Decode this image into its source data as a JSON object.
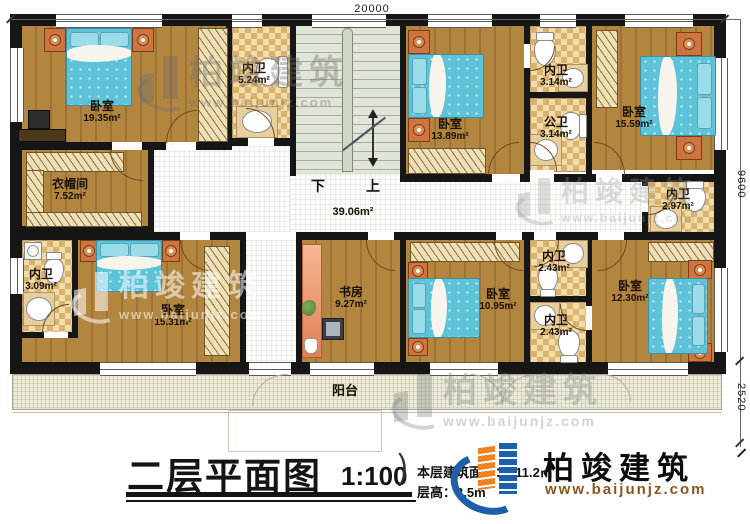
{
  "dims": {
    "top": "20000",
    "right_upper": "9600",
    "right_lower": "2520"
  },
  "rooms": [
    {
      "name": "卧室",
      "area": "19.35m²"
    },
    {
      "name": "内卫",
      "area": "5.24m²"
    },
    {
      "name": "卧室",
      "area": "13.89m²"
    },
    {
      "name": "内卫",
      "area": "3.14m²"
    },
    {
      "name": "公卫",
      "area": "3.14m²"
    },
    {
      "name": "卧室",
      "area": "15.59m²"
    },
    {
      "name": "内卫",
      "area": "2.97m²"
    },
    {
      "name": "衣帽间",
      "area": "7.52m²"
    },
    {
      "name": "内卫",
      "area": "3.09m²"
    },
    {
      "name": "卧室",
      "area": "15.31m²"
    },
    {
      "name": "书房",
      "area": "9.27m²"
    },
    {
      "name": "卧室",
      "area": "10.95m²"
    },
    {
      "name": "内卫",
      "area": "2.43m²"
    },
    {
      "name": "内卫",
      "area": "2.43m²"
    },
    {
      "name": "卧室",
      "area": "12.30m²"
    }
  ],
  "hall": {
    "area": "39.06m²"
  },
  "stairs": {
    "down": "下",
    "up": "上"
  },
  "balcony": {
    "label": "阳台"
  },
  "titleblock": {
    "title": "二层平面图",
    "scale": "1:100",
    "paren": ")",
    "area_label": "本层建筑面积：",
    "area_value": "211.2㎡",
    "height_label": "层高：",
    "height_value": "3.5m"
  },
  "brand": {
    "name": "柏竣建筑",
    "url": "www.baijunjz.com",
    "blue": "#1d5fa8",
    "orange": "#f08221"
  }
}
